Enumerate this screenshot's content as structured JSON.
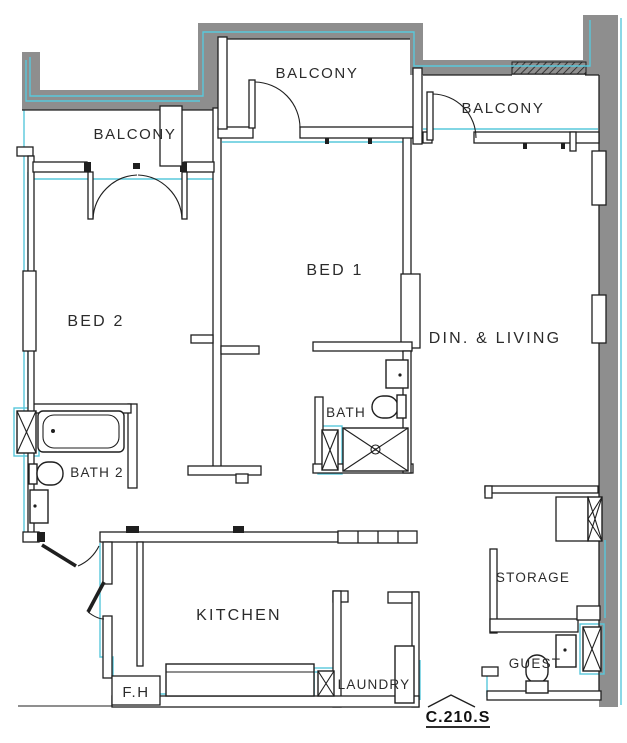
{
  "unit_code": "C.210.S",
  "rooms": {
    "balcony_left": "BALCONY",
    "balcony_mid": "BALCONY",
    "balcony_right": "BALCONY",
    "bed1": "BED 1",
    "bed2": "BED 2",
    "dining_living": "DIN. & LIVING",
    "bath": "BATH",
    "bath2": "BATH 2",
    "kitchen": "KITCHEN",
    "storage": "STORAGE",
    "laundry": "LAUNDRY",
    "guest": "GUEST",
    "fire_hose": "F.H"
  },
  "colors": {
    "wall_gray": "#8e8e8e",
    "line_black": "#1f1f1f",
    "accent_cyan": "#58c8dc",
    "background": "#ffffff",
    "text": "#2b2b2b"
  }
}
